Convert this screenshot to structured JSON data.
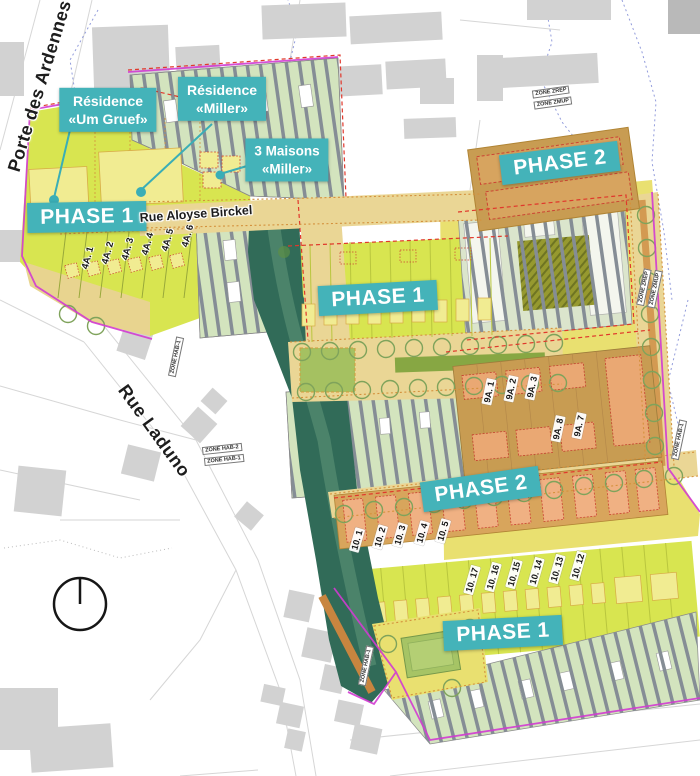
{
  "phases": {
    "west": "PHASE 1",
    "center": "PHASE 1",
    "south": "PHASE 1",
    "north_2": "PHASE 2",
    "center_2": "PHASE 2"
  },
  "residences": {
    "um_gruef": {
      "line1": "Résidence",
      "line2": "«Um Gruef»"
    },
    "miller": {
      "line1": "Résidence",
      "line2": "«Miller»"
    },
    "maisons_miller": {
      "line1": "3 Maisons",
      "line2": "«Miller»"
    }
  },
  "streets": {
    "porte_des_ardennes": "Porte des Ardennes",
    "rue_laduno": "Rue Laduno",
    "rue_aloyse_birckel": "Rue Aloyse Birckel"
  },
  "lots": {
    "a4": [
      "4A. 1",
      "4A. 2",
      "4A. 3",
      "4A. 4",
      "4A. 5",
      "4A. 6"
    ],
    "a9": [
      "9A. 1",
      "9A. 2",
      "9A. 3",
      "9A. 8",
      "9A. 7"
    ],
    "n10": [
      "10. 1",
      "10. 2",
      "10. 3",
      "10. 4",
      "10. 5"
    ],
    "s10": [
      "10. 17",
      "10. 16",
      "10. 15",
      "10. 14",
      "10. 13",
      "10. 12"
    ]
  },
  "zones": [
    "ZONE ZREP",
    "ZONE ZMUP",
    "ZONE HAB-1",
    "ZONE HAB-2",
    "ZONE HAB-1",
    "ZONE ZREP",
    "ZONE ZMUP",
    "ZONE HAB-1",
    "ZONE HAB-1"
  ],
  "colors": {
    "label_teal": "#44b3b9",
    "phase1_yellow_green": "#d8e550",
    "phase2_tan": "#c89c52",
    "phase2_building_orange": "#eaa873",
    "road_tan": "#ead695",
    "garden_stripe_green": "#d3e4be",
    "corridor_dark_green": "#316b58",
    "boundary_magenta": "#d23bd2",
    "red_dashed": "#e0382c",
    "existing_building_gray": "#d2d2d2"
  }
}
